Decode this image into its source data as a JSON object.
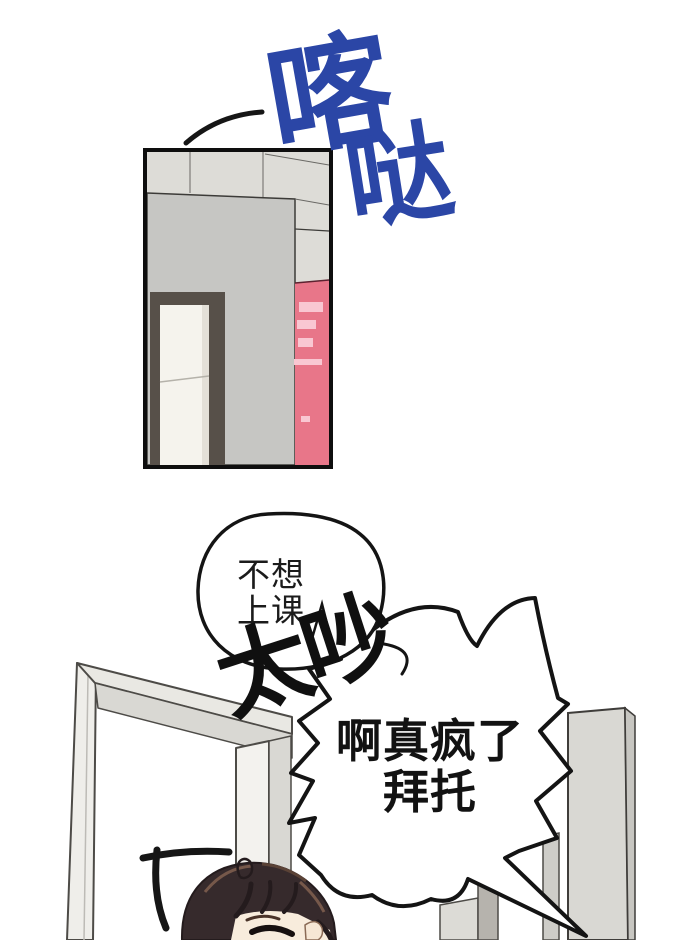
{
  "page": {
    "kind": "comic-page",
    "background_color": "#ffffff"
  },
  "sfx_click": {
    "char1": "喀",
    "char2": "哒",
    "color": "#2b46a6"
  },
  "panel": {
    "ceiling_color": "#dddcd7",
    "wall_color": "#c6c6c3",
    "poster_wall_color": "#e87689",
    "poster_label_color": "#f9c7d2",
    "door_frame_color": "#575049",
    "door_color": "#f5f3ed",
    "border_color": "#0e0e0e"
  },
  "speech_bubble_round": {
    "line1": "不想",
    "line2": "上课"
  },
  "sfx_shout": {
    "text": "太吵"
  },
  "speech_bubble_spiky": {
    "line1": "啊真疯了",
    "line2": "拜托"
  },
  "scene": {
    "doorway_color": "#e9e8e3",
    "pillar_color": "#d9d8d3",
    "hair_color": "#362a2c",
    "skin_color": "#f8ecdc",
    "ink_color": "#161616"
  }
}
